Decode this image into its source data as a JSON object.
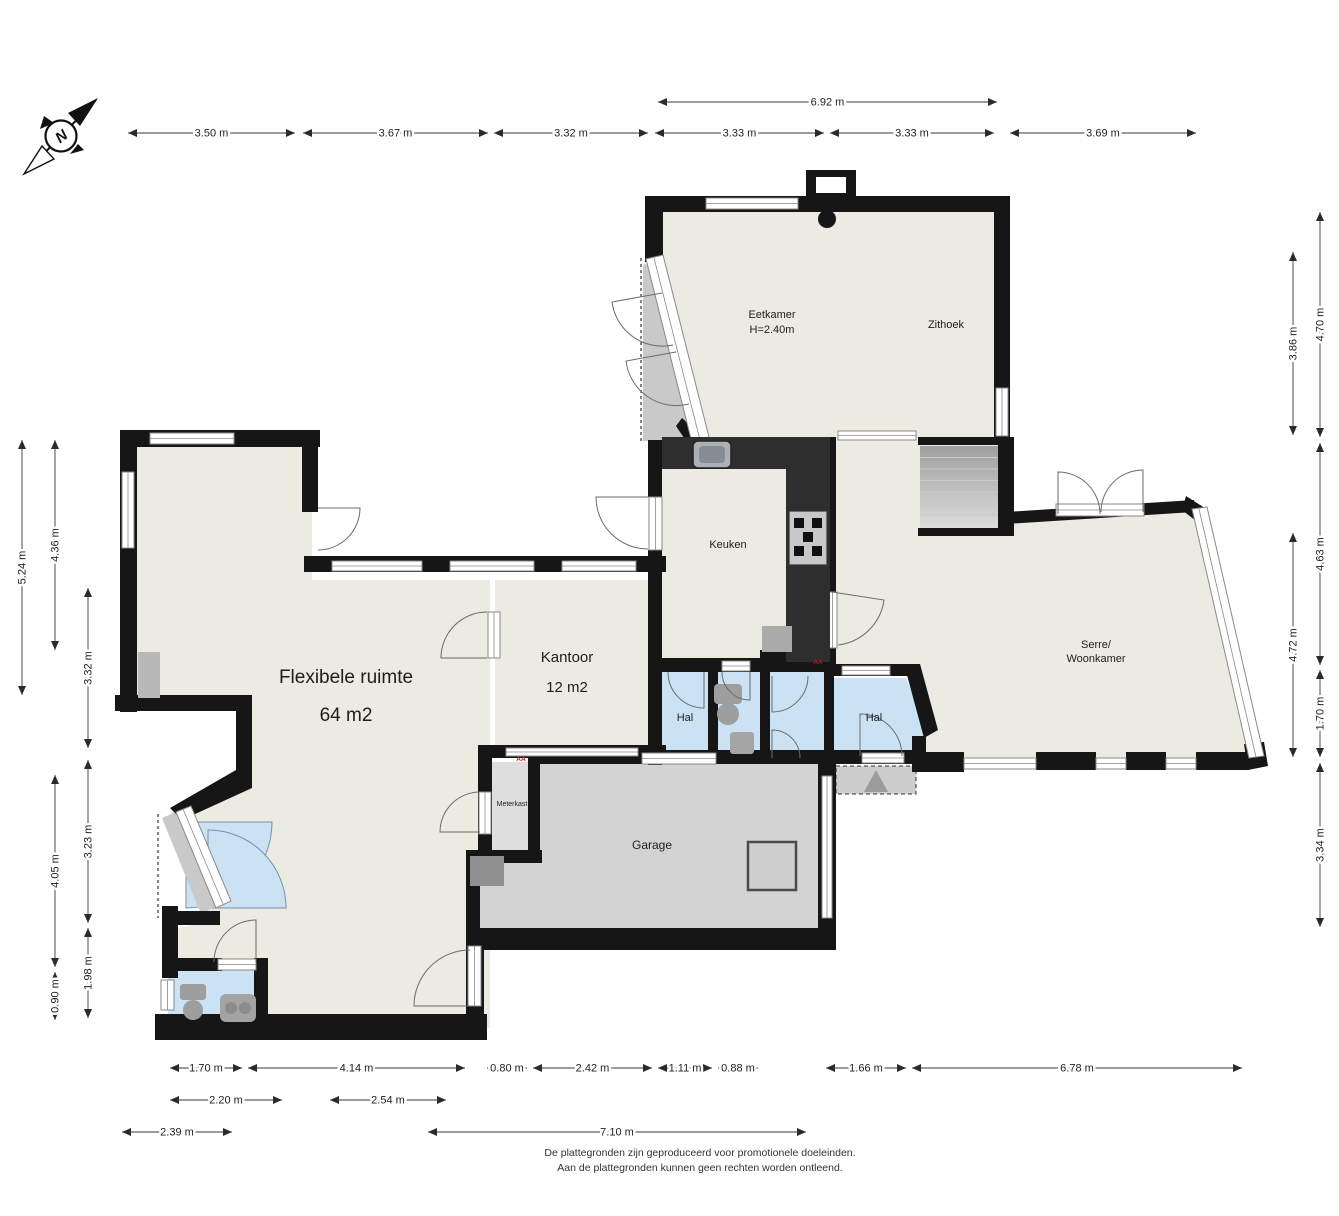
{
  "compass": {
    "label": "N"
  },
  "rooms": [
    {
      "id": "eetkamer",
      "lines": [
        "Eetkamer",
        "H=2.40m"
      ],
      "x": 772,
      "y": 318,
      "size": 11,
      "lh": 15
    },
    {
      "id": "zithoek",
      "lines": [
        "Zithoek"
      ],
      "x": 946,
      "y": 328,
      "size": 11,
      "lh": 15
    },
    {
      "id": "keuken",
      "lines": [
        "Keuken"
      ],
      "x": 728,
      "y": 548,
      "size": 11,
      "lh": 15
    },
    {
      "id": "serre-woonkamer",
      "lines": [
        "Serre/",
        "Woonkamer"
      ],
      "x": 1096,
      "y": 648,
      "size": 11,
      "lh": 14
    },
    {
      "id": "flexibele-ruimte",
      "lines": [
        "Flexibele ruimte",
        "64 m2"
      ],
      "x": 346,
      "y": 683,
      "size": 19,
      "lh": 38
    },
    {
      "id": "kantoor",
      "lines": [
        "Kantoor",
        "12 m2"
      ],
      "x": 567,
      "y": 662,
      "size": 15,
      "lh": 30
    },
    {
      "id": "hal-west",
      "lines": [
        "Hal"
      ],
      "x": 685,
      "y": 721,
      "size": 11,
      "lh": 15
    },
    {
      "id": "hal-east",
      "lines": [
        "Hal"
      ],
      "x": 874,
      "y": 721,
      "size": 11,
      "lh": 15
    },
    {
      "id": "garage",
      "lines": [
        "Garage"
      ],
      "x": 652,
      "y": 849,
      "size": 12,
      "lh": 15
    },
    {
      "id": "meterkast",
      "lines": [
        "Meterkast"
      ],
      "x": 512,
      "y": 806,
      "size": 7,
      "lh": 9
    }
  ],
  "markers": [
    {
      "label": "AA",
      "x": 521,
      "y": 761
    },
    {
      "label": "AA",
      "x": 818,
      "y": 664
    }
  ],
  "dimensions": [
    {
      "label": "6.92 m",
      "x1": 658,
      "y1": 102,
      "x2": 997,
      "y2": 102
    },
    {
      "label": "3.50 m",
      "x1": 128,
      "y1": 133,
      "x2": 295,
      "y2": 133
    },
    {
      "label": "3.67 m",
      "x1": 303,
      "y1": 133,
      "x2": 488,
      "y2": 133
    },
    {
      "label": "3.32 m",
      "x1": 494,
      "y1": 133,
      "x2": 648,
      "y2": 133
    },
    {
      "label": "3.33 m",
      "x1": 655,
      "y1": 133,
      "x2": 824,
      "y2": 133
    },
    {
      "label": "3.33 m",
      "x1": 830,
      "y1": 133,
      "x2": 994,
      "y2": 133
    },
    {
      "label": "3.69 m",
      "x1": 1010,
      "y1": 133,
      "x2": 1196,
      "y2": 133
    },
    {
      "label": "5.24 m",
      "x1": 22,
      "y1": 440,
      "x2": 22,
      "y2": 695
    },
    {
      "label": "4.36 m",
      "x1": 55,
      "y1": 440,
      "x2": 55,
      "y2": 650
    },
    {
      "label": "3.32 m",
      "x1": 88,
      "y1": 588,
      "x2": 88,
      "y2": 748
    },
    {
      "label": "4.05 m",
      "x1": 55,
      "y1": 775,
      "x2": 55,
      "y2": 967
    },
    {
      "label": "0.90 m",
      "x1": 55,
      "y1": 972,
      "x2": 55,
      "y2": 1020
    },
    {
      "label": "3.23 m",
      "x1": 88,
      "y1": 760,
      "x2": 88,
      "y2": 923
    },
    {
      "label": "1.98 m",
      "x1": 88,
      "y1": 928,
      "x2": 88,
      "y2": 1018
    },
    {
      "label": "3.86 m",
      "x1": 1293,
      "y1": 252,
      "x2": 1293,
      "y2": 435
    },
    {
      "label": "4.70 m",
      "x1": 1320,
      "y1": 212,
      "x2": 1320,
      "y2": 437
    },
    {
      "label": "4.63 m",
      "x1": 1320,
      "y1": 443,
      "x2": 1320,
      "y2": 665
    },
    {
      "label": "4.72 m",
      "x1": 1293,
      "y1": 533,
      "x2": 1293,
      "y2": 757
    },
    {
      "label": "1.70 m",
      "x1": 1320,
      "y1": 670,
      "x2": 1320,
      "y2": 757
    },
    {
      "label": "3.34 m",
      "x1": 1320,
      "y1": 763,
      "x2": 1320,
      "y2": 927
    },
    {
      "label": "1.70 m",
      "x1": 170,
      "y1": 1068,
      "x2": 242,
      "y2": 1068
    },
    {
      "label": "4.14 m",
      "x1": 248,
      "y1": 1068,
      "x2": 465,
      "y2": 1068
    },
    {
      "label": "0.80 m",
      "x1": 487,
      "y1": 1068,
      "x2": 527,
      "y2": 1068
    },
    {
      "label": "2.42 m",
      "x1": 533,
      "y1": 1068,
      "x2": 652,
      "y2": 1068
    },
    {
      "label": "1.11 m",
      "x1": 658,
      "y1": 1068,
      "x2": 712,
      "y2": 1068
    },
    {
      "label": "0.88 m",
      "x1": 718,
      "y1": 1068,
      "x2": 758,
      "y2": 1068
    },
    {
      "label": "1.66 m",
      "x1": 826,
      "y1": 1068,
      "x2": 906,
      "y2": 1068
    },
    {
      "label": "6.78 m",
      "x1": 912,
      "y1": 1068,
      "x2": 1242,
      "y2": 1068
    },
    {
      "label": "2.20 m",
      "x1": 170,
      "y1": 1100,
      "x2": 282,
      "y2": 1100
    },
    {
      "label": "2.54 m",
      "x1": 330,
      "y1": 1100,
      "x2": 446,
      "y2": 1100
    },
    {
      "label": "2.39 m",
      "x1": 122,
      "y1": 1132,
      "x2": 232,
      "y2": 1132
    },
    {
      "label": "7.10 m",
      "x1": 428,
      "y1": 1132,
      "x2": 806,
      "y2": 1132
    }
  ],
  "footer": {
    "line1": "De plattegronden zijn geproduceerd voor promotionele doeleinden.",
    "line2": "Aan de plattegronden kunnen geen rechten worden ontleend."
  },
  "colors": {
    "wall": "#161616",
    "floor": "#EBEBE1",
    "garage": "#D3D3D3",
    "meterkast": "#DEDEDE",
    "hal": "#CAE2F4",
    "counter": "#2E2E2E",
    "deck": "#C9C9C9",
    "dim": "#3a3a3a",
    "label": "#1d1d1d",
    "marker_red": "#C41212",
    "fixture": "#9E9E9E",
    "window_frame": "#8a8a8a"
  }
}
